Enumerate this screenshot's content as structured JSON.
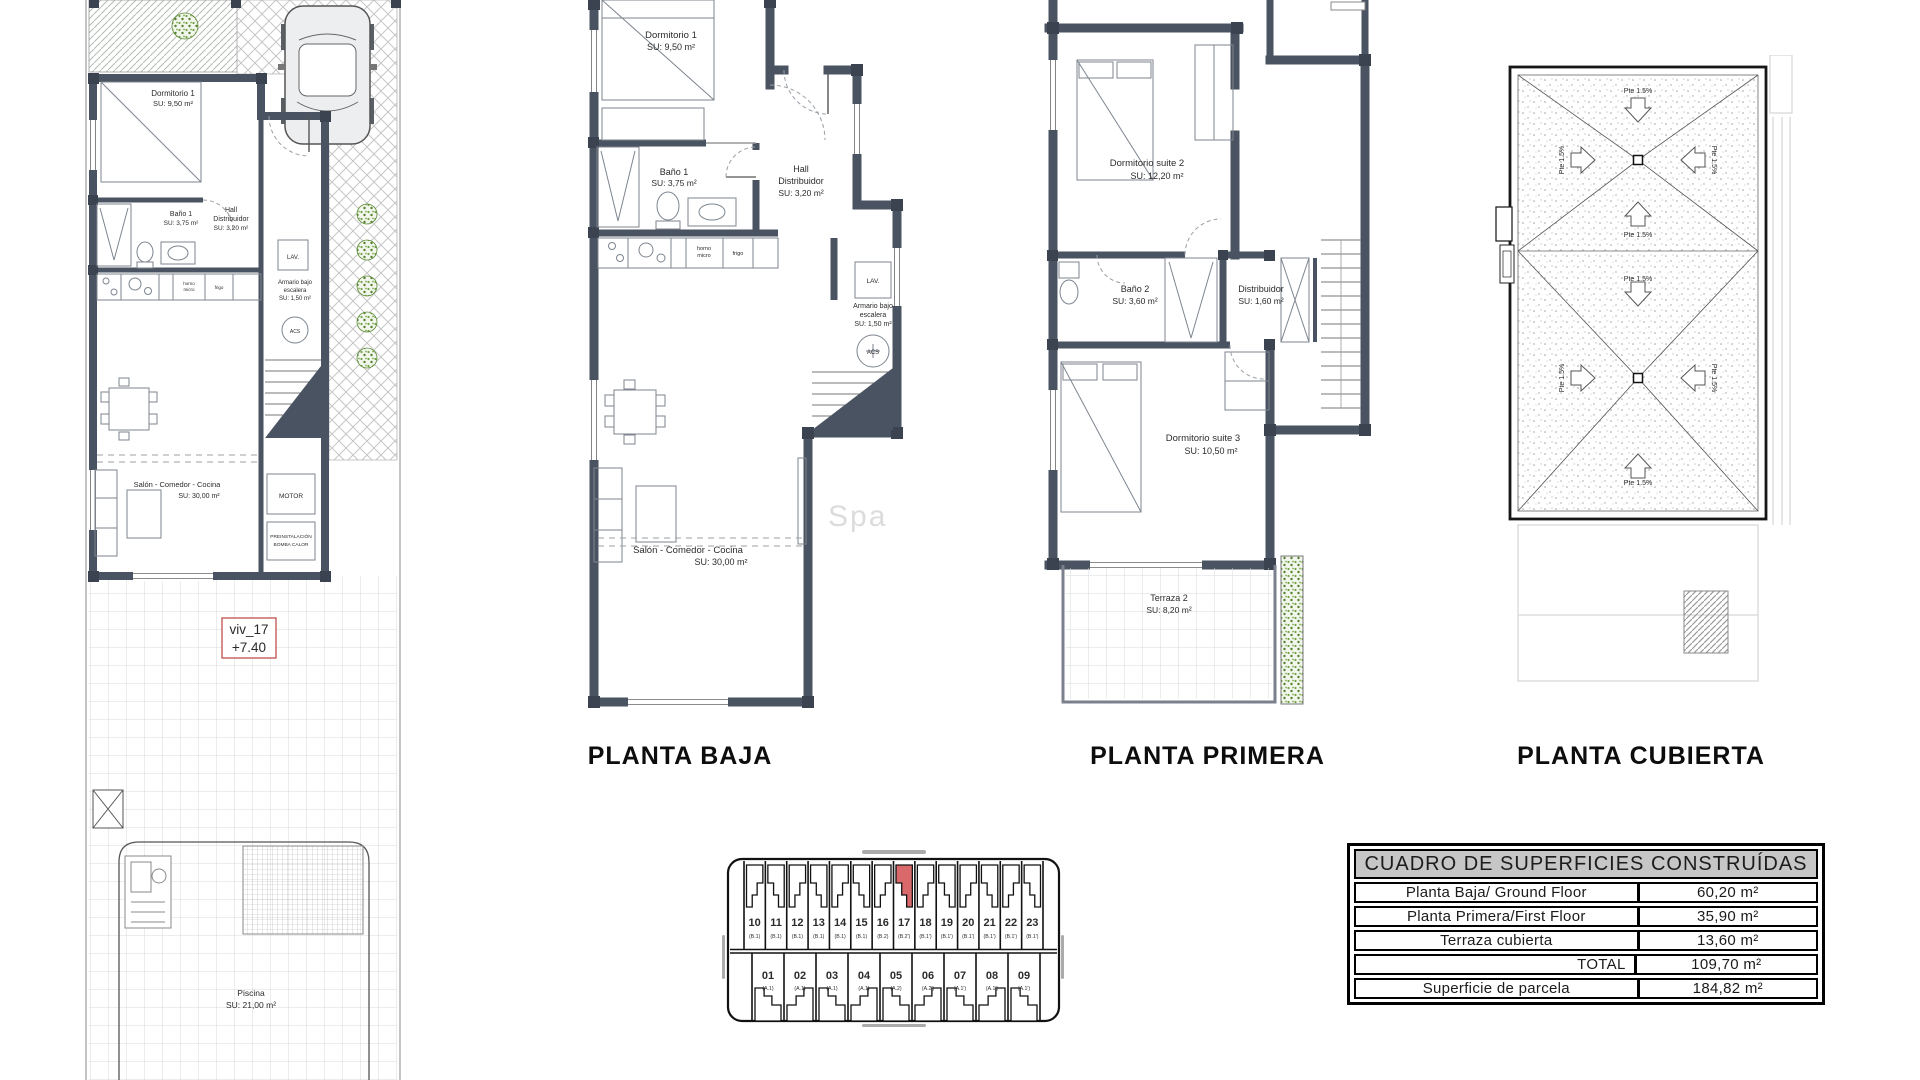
{
  "document": {
    "watermark": "Spa"
  },
  "ground_rooms": {
    "dormitorio": {
      "name": "Dormitorio 1",
      "area": "SU: 9,50 m²"
    },
    "bano": {
      "name": "Baño 1",
      "area": "SU: 3,75 m²"
    },
    "hall": {
      "line1": "Hall",
      "line2": "Distribuidor",
      "area": "SU: 3,20 m²"
    },
    "armario": {
      "line1": "Armario bajo",
      "line2": "escalera",
      "area": "SU: 1,50 m²"
    },
    "salon": {
      "name": "Salón - Comedor - Cocina",
      "area": "SU: 30,00 m²"
    }
  },
  "fixtures": {
    "lav": "LAV.",
    "acs": "ACS",
    "horno_line1": "horno",
    "horno_line2": "micro",
    "frigo": "frigo",
    "motor": "MOTOR",
    "preinstalacion_line1": "PREINSTALACIÓN",
    "preinstalacion_line2": "BOMBA CALOR"
  },
  "site_plan": {
    "unit_ref": "viv_17",
    "level": "+7.40",
    "piscina": {
      "name": "Piscina",
      "area": "SU: 21,00 m²"
    }
  },
  "planta_baja": {
    "title": "PLANTA BAJA"
  },
  "planta_primera": {
    "title": "PLANTA PRIMERA",
    "rooms": {
      "suite2": {
        "name": "Dormitorio suite 2",
        "area": "SU: 12,20 m²"
      },
      "bano2": {
        "name": "Baño 2",
        "area": "SU: 3,60 m²"
      },
      "distribuidor": {
        "name": "Distribuidor",
        "area": "SU: 1,60 m²"
      },
      "suite3": {
        "name": "Dormitorio suite 3",
        "area": "SU: 10,50 m²"
      },
      "terraza2": {
        "name": "Terraza 2",
        "area": "SU: 8,20 m²"
      }
    }
  },
  "planta_cubierta": {
    "title": "PLANTA CUBIERTA",
    "slope_label": "Pte 1.5%"
  },
  "site_key": {
    "highlight_color": "#d9696b",
    "top_units": [
      {
        "num": "10",
        "type": "(B.1)"
      },
      {
        "num": "11",
        "type": "(B.1)"
      },
      {
        "num": "12",
        "type": "(B.1)"
      },
      {
        "num": "13",
        "type": "(B.1)"
      },
      {
        "num": "14",
        "type": "(B.1)"
      },
      {
        "num": "15",
        "type": "(B.1)"
      },
      {
        "num": "16",
        "type": "(B.2)"
      },
      {
        "num": "17",
        "type": "(B.2')",
        "highlight": true
      },
      {
        "num": "18",
        "type": "(B.1')"
      },
      {
        "num": "19",
        "type": "(B.1')"
      },
      {
        "num": "20",
        "type": "(B.1')"
      },
      {
        "num": "21",
        "type": "(B.1')"
      },
      {
        "num": "22",
        "type": "(B.1')"
      },
      {
        "num": "23",
        "type": "(B.1')"
      }
    ],
    "bottom_units": [
      {
        "num": "01",
        "type": "(A.1)"
      },
      {
        "num": "02",
        "type": "(A.1)"
      },
      {
        "num": "03",
        "type": "(A.1)"
      },
      {
        "num": "04",
        "type": "(A.1)"
      },
      {
        "num": "05",
        "type": "(A.2)"
      },
      {
        "num": "06",
        "type": "(A.2')"
      },
      {
        "num": "07",
        "type": "(A.1')"
      },
      {
        "num": "08",
        "type": "(A.1')"
      },
      {
        "num": "09",
        "type": "(A.1')"
      }
    ]
  },
  "surfaces_table": {
    "title": "CUADRO DE SUPERFICIES CONSTRUÍDAS",
    "rows": [
      {
        "label": "Planta Baja/ Ground Floor",
        "value": "60,20 m²"
      },
      {
        "label": "Planta Primera/First Floor",
        "value": "35,90 m²"
      },
      {
        "label": "Terraza cubierta",
        "value": "13,60 m²"
      },
      {
        "label": "TOTAL",
        "value": "109,70 m²",
        "total": true
      },
      {
        "label": "Superficie de parcela",
        "value": "184,82 m²"
      }
    ]
  },
  "colors": {
    "wall": "#4a5361",
    "wall_corner": "#3c4350",
    "red_accent": "#c0504d",
    "unit_highlight": "#d9696b",
    "hedge_green": "#6f9f45",
    "grid_line": "#d7dadd",
    "table_header_bg": "#c6c6c6"
  }
}
